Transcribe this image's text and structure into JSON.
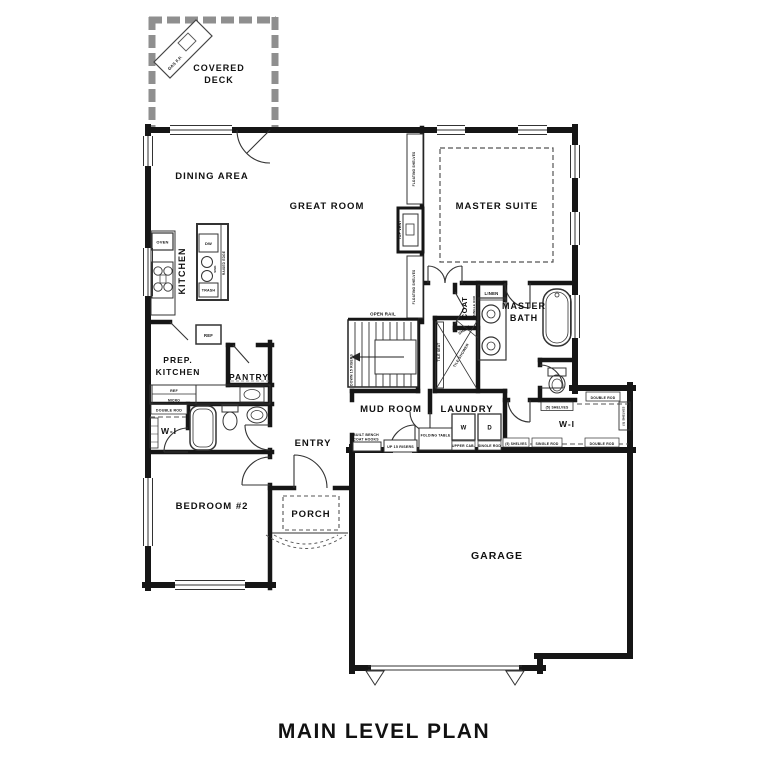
{
  "title": "MAIN LEVEL PLAN",
  "rooms": {
    "covered_deck": {
      "line1": "COVERED",
      "line2": "DECK"
    },
    "dining_area": "DINING AREA",
    "great_room": "GREAT ROOM",
    "master_suite": "MASTER SUITE",
    "kitchen": "KITCHEN",
    "prep_kitchen": {
      "line1": "PREP.",
      "line2": "KITCHEN"
    },
    "pantry": "PANTRY",
    "walk_in_left": "W-I",
    "bedroom_2": "BEDROOM #2",
    "entry": "ENTRY",
    "porch": "PORCH",
    "garage": "GARAGE",
    "mud_room": "MUD ROOM",
    "laundry": "LAUNDRY",
    "master_bath": {
      "line1": "MASTER",
      "line2": "BATH"
    },
    "walk_in_master": "W-I",
    "coat": "COAT",
    "linen": "LINEN"
  },
  "kitchen_fixtures": {
    "oven": "OVEN",
    "dishwasher": "DW",
    "sink": "SINK",
    "trash": "TRASH",
    "raised_edge": "RAISED EDGE",
    "fridge": "REF",
    "prep_fridge": "REF",
    "prep_micro": "MICRO"
  },
  "great_room_fixtures": {
    "top_vent": "TOP VENT",
    "floating_shelves_upper": "FLOATING SHELVES",
    "floating_shelves_lower": "FLOATING SHELVES"
  },
  "deck_fixtures": {
    "gas_fireplace": "GAS F.P."
  },
  "stairs": {
    "open_rail": "OPEN RAIL",
    "down": "DOWN 15 RISERS",
    "up": "UP 15 RISERS"
  },
  "mud_laundry": {
    "built_bench": "BUILT BENCH",
    "coat_hooks": "COAT HOOKS",
    "folding_table": "FOLDING TABLE",
    "washer": "W",
    "dryer": "D",
    "upper_cab": "UPPER CAB.",
    "single_rod": "SINGLE ROD"
  },
  "bath_fixtures": {
    "tile_seat": "TILE SEAT",
    "tile_shower": "TILE SHOWER",
    "shelf": "SHELF"
  },
  "closet_fixtures": {
    "double_rod_left": "DOUBLE ROD",
    "single_rod_coat": "SINGLE ROD",
    "wc_shelves": "(5) SHELVES",
    "wi_double_rod_top": "DOUBLE ROD",
    "wi_shelves_bottom": "(5) SHELVES",
    "wi_single_rod_bottom": "SINGLE ROD",
    "wi_double_rod_bottom": "DOUBLE ROD",
    "wi_shelves_side": "(5) SHELVES"
  }
}
